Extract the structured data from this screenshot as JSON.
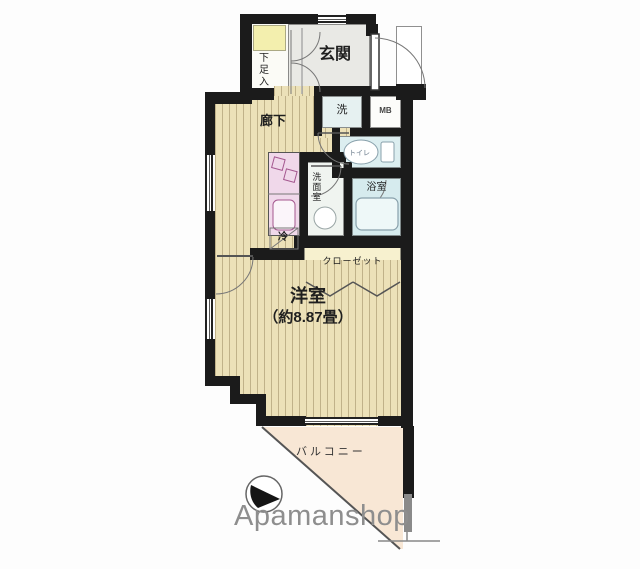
{
  "plan": {
    "labels": {
      "genkan": "玄関",
      "shoe_box": "下足入",
      "hallway": "廊下",
      "washer": "洗",
      "meter_box": "MB",
      "toilet": "トイレ",
      "washroom": "洗面室",
      "bathroom": "浴室",
      "fridge": "冷",
      "closet": "クローゼット",
      "room": "洋室",
      "room_size": "（約8.87畳）",
      "balcony": "バルコニー"
    },
    "branding": {
      "logo_text": "Apamanshop"
    },
    "colors": {
      "wall": "#1b1b1b",
      "wood_floor": "#ece1b8",
      "genkan_floor": "#e9e9e5",
      "bathroom_floor": "#d6ebee",
      "toilet_floor": "#dceef0",
      "kitchen_unit": "#f0d8ea",
      "closet_floor": "#f7f1cf",
      "balcony_floor": "#f8e7d5",
      "shoe_cabinet": "#f3efae",
      "logo_text": "#8e8e8e"
    }
  }
}
